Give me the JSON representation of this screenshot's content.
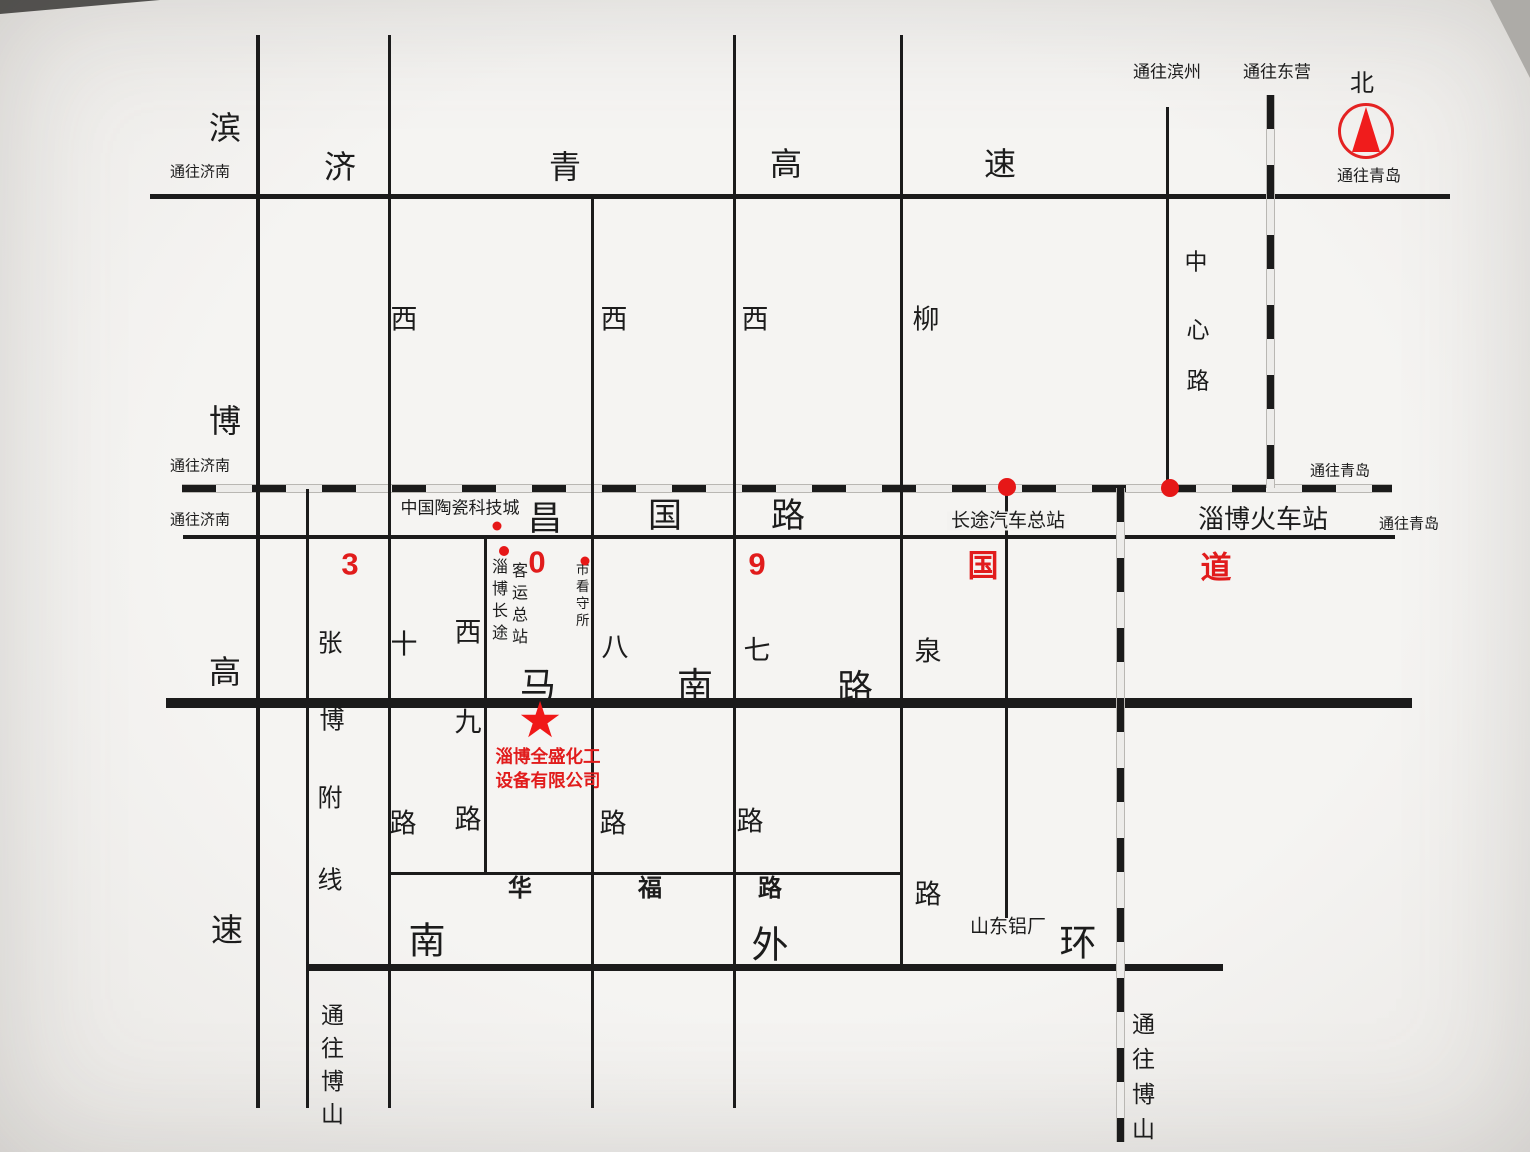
{
  "colors": {
    "background": "#f3f2f0",
    "road": "#1b1b1b",
    "accent_red": "#e11c1c"
  },
  "compass": {
    "north": "北",
    "to_qingdao": "通往青岛"
  },
  "edges": {
    "to_jinan_top": "通往济南",
    "to_jinan_railway": "通往济南",
    "to_jinan_changguo": "通往济南",
    "to_binzhou": "通往滨州",
    "to_dongying": "通往东营",
    "to_qingdao_railway": "通往青岛",
    "to_qingdao_changguo": "通往青岛",
    "to_boshan_west": "通往博山",
    "to_boshan_railway": "通往博山"
  },
  "roads": {
    "binbo_expressway": {
      "name": "滨博高速",
      "chars": [
        "滨",
        "博",
        "高",
        "速"
      ]
    },
    "jiqing_expressway": {
      "name": "济青高速",
      "chars": [
        "济",
        "青",
        "高",
        "速"
      ]
    },
    "changguo_road": {
      "name": "昌国路",
      "chars": [
        "昌",
        "国",
        "路"
      ]
    },
    "manan_road": {
      "name": "马南路",
      "chars": [
        "马",
        "南",
        "路"
      ]
    },
    "south_outer_ring": {
      "name": "南外环",
      "chars": [
        "南",
        "外",
        "环"
      ]
    },
    "huafu_road": {
      "name": "华福路",
      "chars": [
        "华",
        "福",
        "路"
      ]
    },
    "xishi_road": {
      "name": "西十路",
      "chars": [
        "西",
        "十",
        "路"
      ]
    },
    "xijiu_road": {
      "name": "西九路",
      "chars": [
        "西",
        "九",
        "路"
      ]
    },
    "xiba_road": {
      "name": "西八路",
      "chars": [
        "西",
        "八",
        "路"
      ]
    },
    "xiqi_road": {
      "name": "西七路",
      "chars": [
        "西",
        "七",
        "路"
      ]
    },
    "liuquan_road": {
      "name": "柳泉路",
      "chars": [
        "柳",
        "泉",
        "路"
      ]
    },
    "zhangbo_branch": {
      "name": "张博附线",
      "chars": [
        "张",
        "博",
        "附",
        "线"
      ]
    },
    "zhongxin_road": {
      "name": "中心路",
      "chars": [
        "中",
        "心",
        "路"
      ]
    }
  },
  "route_309": {
    "name": "309国道",
    "chars": [
      "3",
      "0",
      "9",
      "国",
      "道"
    ]
  },
  "pois": {
    "ceramics_city": "中国陶瓷科技城",
    "bus_terminal_col_left": "淄博长途",
    "bus_terminal_col_right": "客运总站",
    "detention_center": "市看守所",
    "long_distance_bus_station": "长途汽车总站",
    "zibo_railway_station": "淄博火车站",
    "shandong_aluminum": "山东铝厂"
  },
  "company": {
    "marker": "★",
    "line1": "淄博全盛化工",
    "line2": "设备有限公司"
  }
}
